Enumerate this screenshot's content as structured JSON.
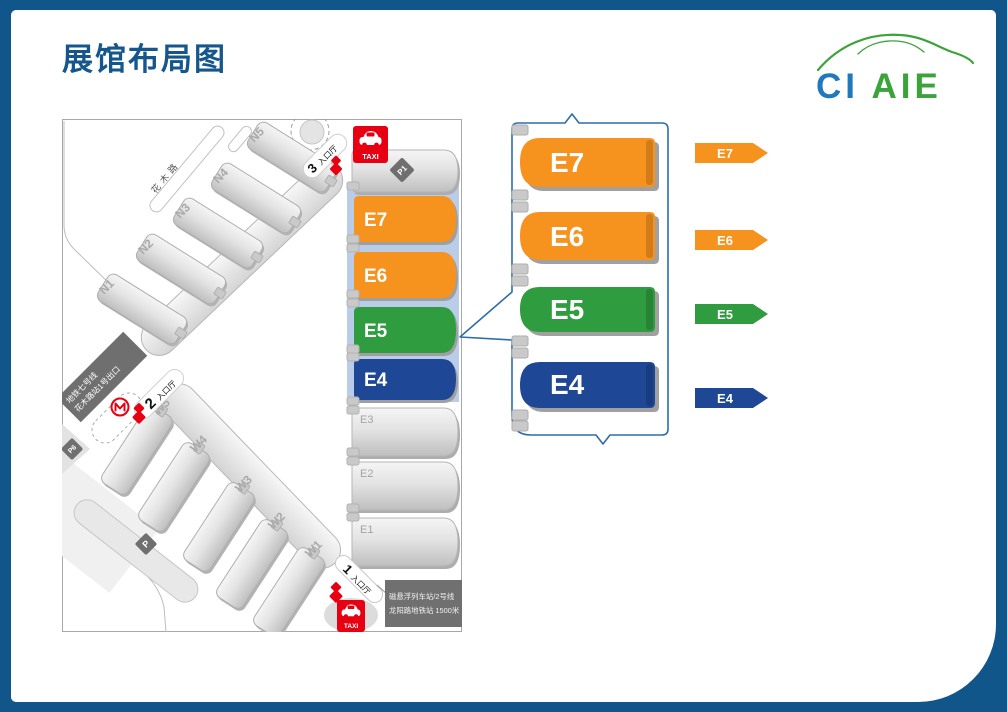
{
  "page": {
    "title": "展馆布局图"
  },
  "logo": {
    "blue": "CI",
    "green": "AIE"
  },
  "e_halls": [
    {
      "id": "E7",
      "color": "#F6921E"
    },
    {
      "id": "E6",
      "color": "#F6921E"
    },
    {
      "id": "E5",
      "color": "#2F9C3F"
    },
    {
      "id": "E4",
      "color": "#1E4796"
    }
  ],
  "map": {
    "roads": {
      "huamu": "花木路",
      "fangdian": "芳甸路"
    },
    "n_halls": [
      "N1",
      "N2",
      "N3",
      "N4",
      "N5"
    ],
    "w_halls": [
      "W1",
      "W2",
      "W3",
      "W4",
      "W5"
    ],
    "e_gray": [
      "E3",
      "E2",
      "E1"
    ],
    "parking": {
      "p1": "P1",
      "p6": "P6",
      "p": "P"
    },
    "entrances": {
      "e3": {
        "num": "3",
        "label": "入口厅"
      },
      "e2": {
        "num": "2",
        "label": "入口厅"
      },
      "e1": {
        "num": "1",
        "label": "入口厅"
      }
    },
    "taxi": "TAXI",
    "metro_sign": {
      "line1": "地铁七号线",
      "line2": "花木路站1号出口"
    },
    "info_sign": {
      "line1": "磁悬浮列车站/2号线",
      "line2": "龙阳路地铁站 1500米"
    }
  }
}
